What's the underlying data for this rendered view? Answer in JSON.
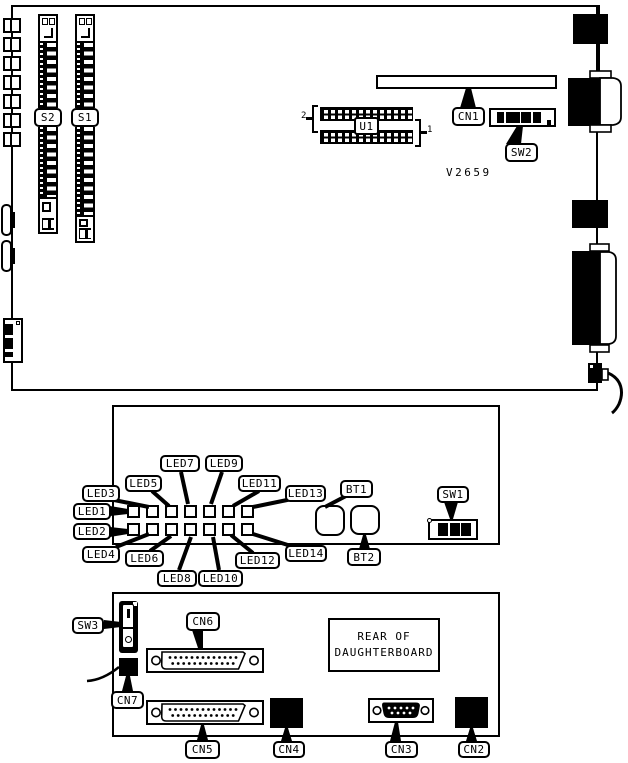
{
  "diagram": {
    "main_board": {
      "s2_label": "S2",
      "s1_label": "S1",
      "u1_label": "U1",
      "cn1_label": "CN1",
      "sw2_label": "SW2",
      "part_number": "V2659",
      "pin_marker_top": "2",
      "pin_marker_bottom": "1"
    },
    "led_board": {
      "led_labels": [
        "LED1",
        "LED2",
        "LED3",
        "LED4",
        "LED5",
        "LED6",
        "LED7",
        "LED8",
        "LED9",
        "LED10",
        "LED11",
        "LED12",
        "LED13",
        "LED14"
      ],
      "bt1_label": "BT1",
      "bt2_label": "BT2",
      "sw1_label": "SW1"
    },
    "daughterboard": {
      "sw3_label": "SW3",
      "cn6_label": "CN6",
      "cn7_label": "CN7",
      "cn5_label": "CN5",
      "cn4_label": "CN4",
      "cn3_label": "CN3",
      "cn2_label": "CN2",
      "title_line1": "REAR OF",
      "title_line2": "DAUGHTERBOARD"
    },
    "colors": {
      "ink": "#000000",
      "paper": "#ffffff"
    }
  }
}
